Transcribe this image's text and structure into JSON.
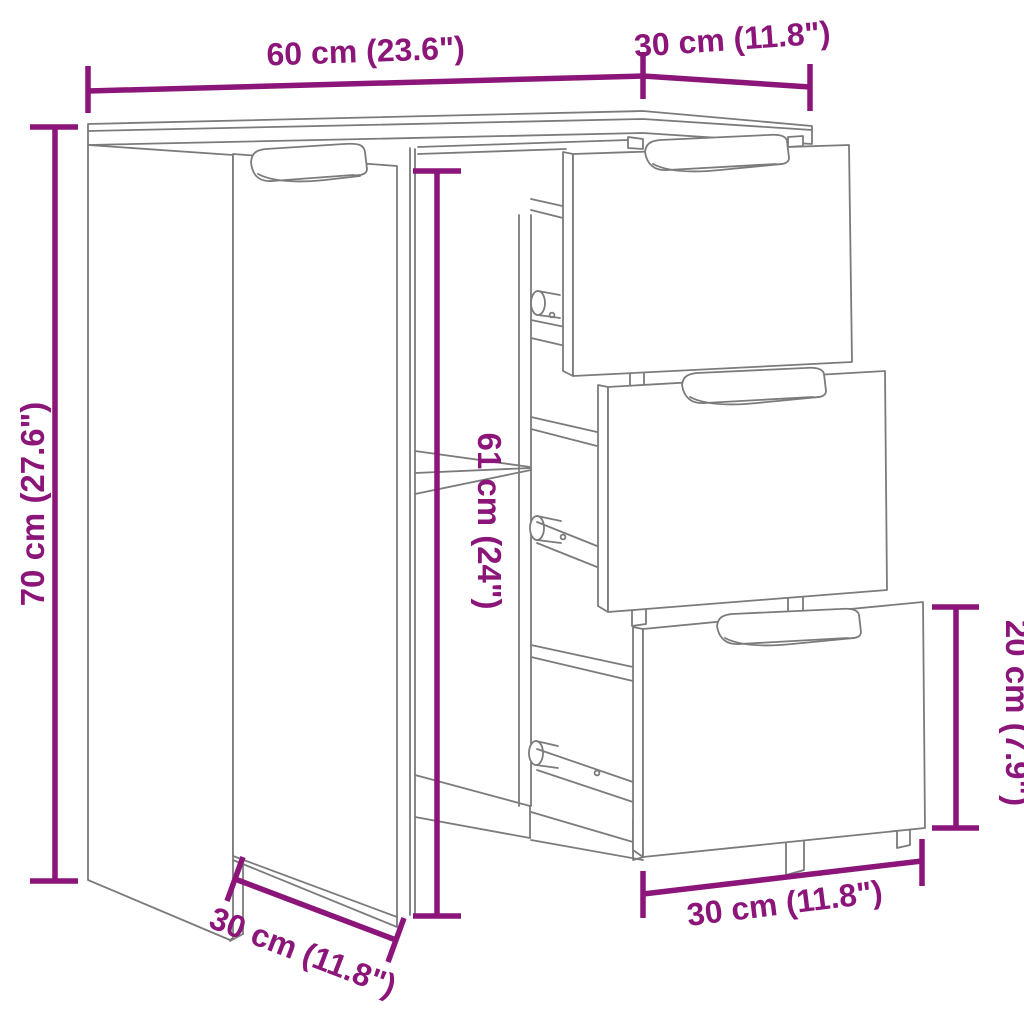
{
  "page": {
    "background": "#ffffff"
  },
  "diagram": {
    "type": "furniture-dimension-line-drawing",
    "subject": "sideboard with one door, one shelf and three pulled-out drawers",
    "accent_color": "#8B1579",
    "outline_color": "#7b7b7b",
    "dimensions": {
      "width_top": {
        "label": "60 cm (23.6\")",
        "value_cm": 60,
        "value_in": 23.6
      },
      "depth_top": {
        "label": "30 cm (11.8\")",
        "value_cm": 30,
        "value_in": 11.8
      },
      "height_left": {
        "label": "70 cm (27.6\")",
        "value_cm": 70,
        "value_in": 27.6
      },
      "interior_height": {
        "label": "61 cm (24\")",
        "value_cm": 61,
        "value_in": 24
      },
      "drawer_height": {
        "label": "20 cm (7.9\")",
        "value_cm": 20,
        "value_in": 7.9
      },
      "drawer_width": {
        "label": "30 cm (11.8\")",
        "value_cm": 30,
        "value_in": 11.8
      },
      "depth_bottom": {
        "label": "30 cm (11.8\")",
        "value_cm": 30,
        "value_in": 11.8
      }
    }
  }
}
